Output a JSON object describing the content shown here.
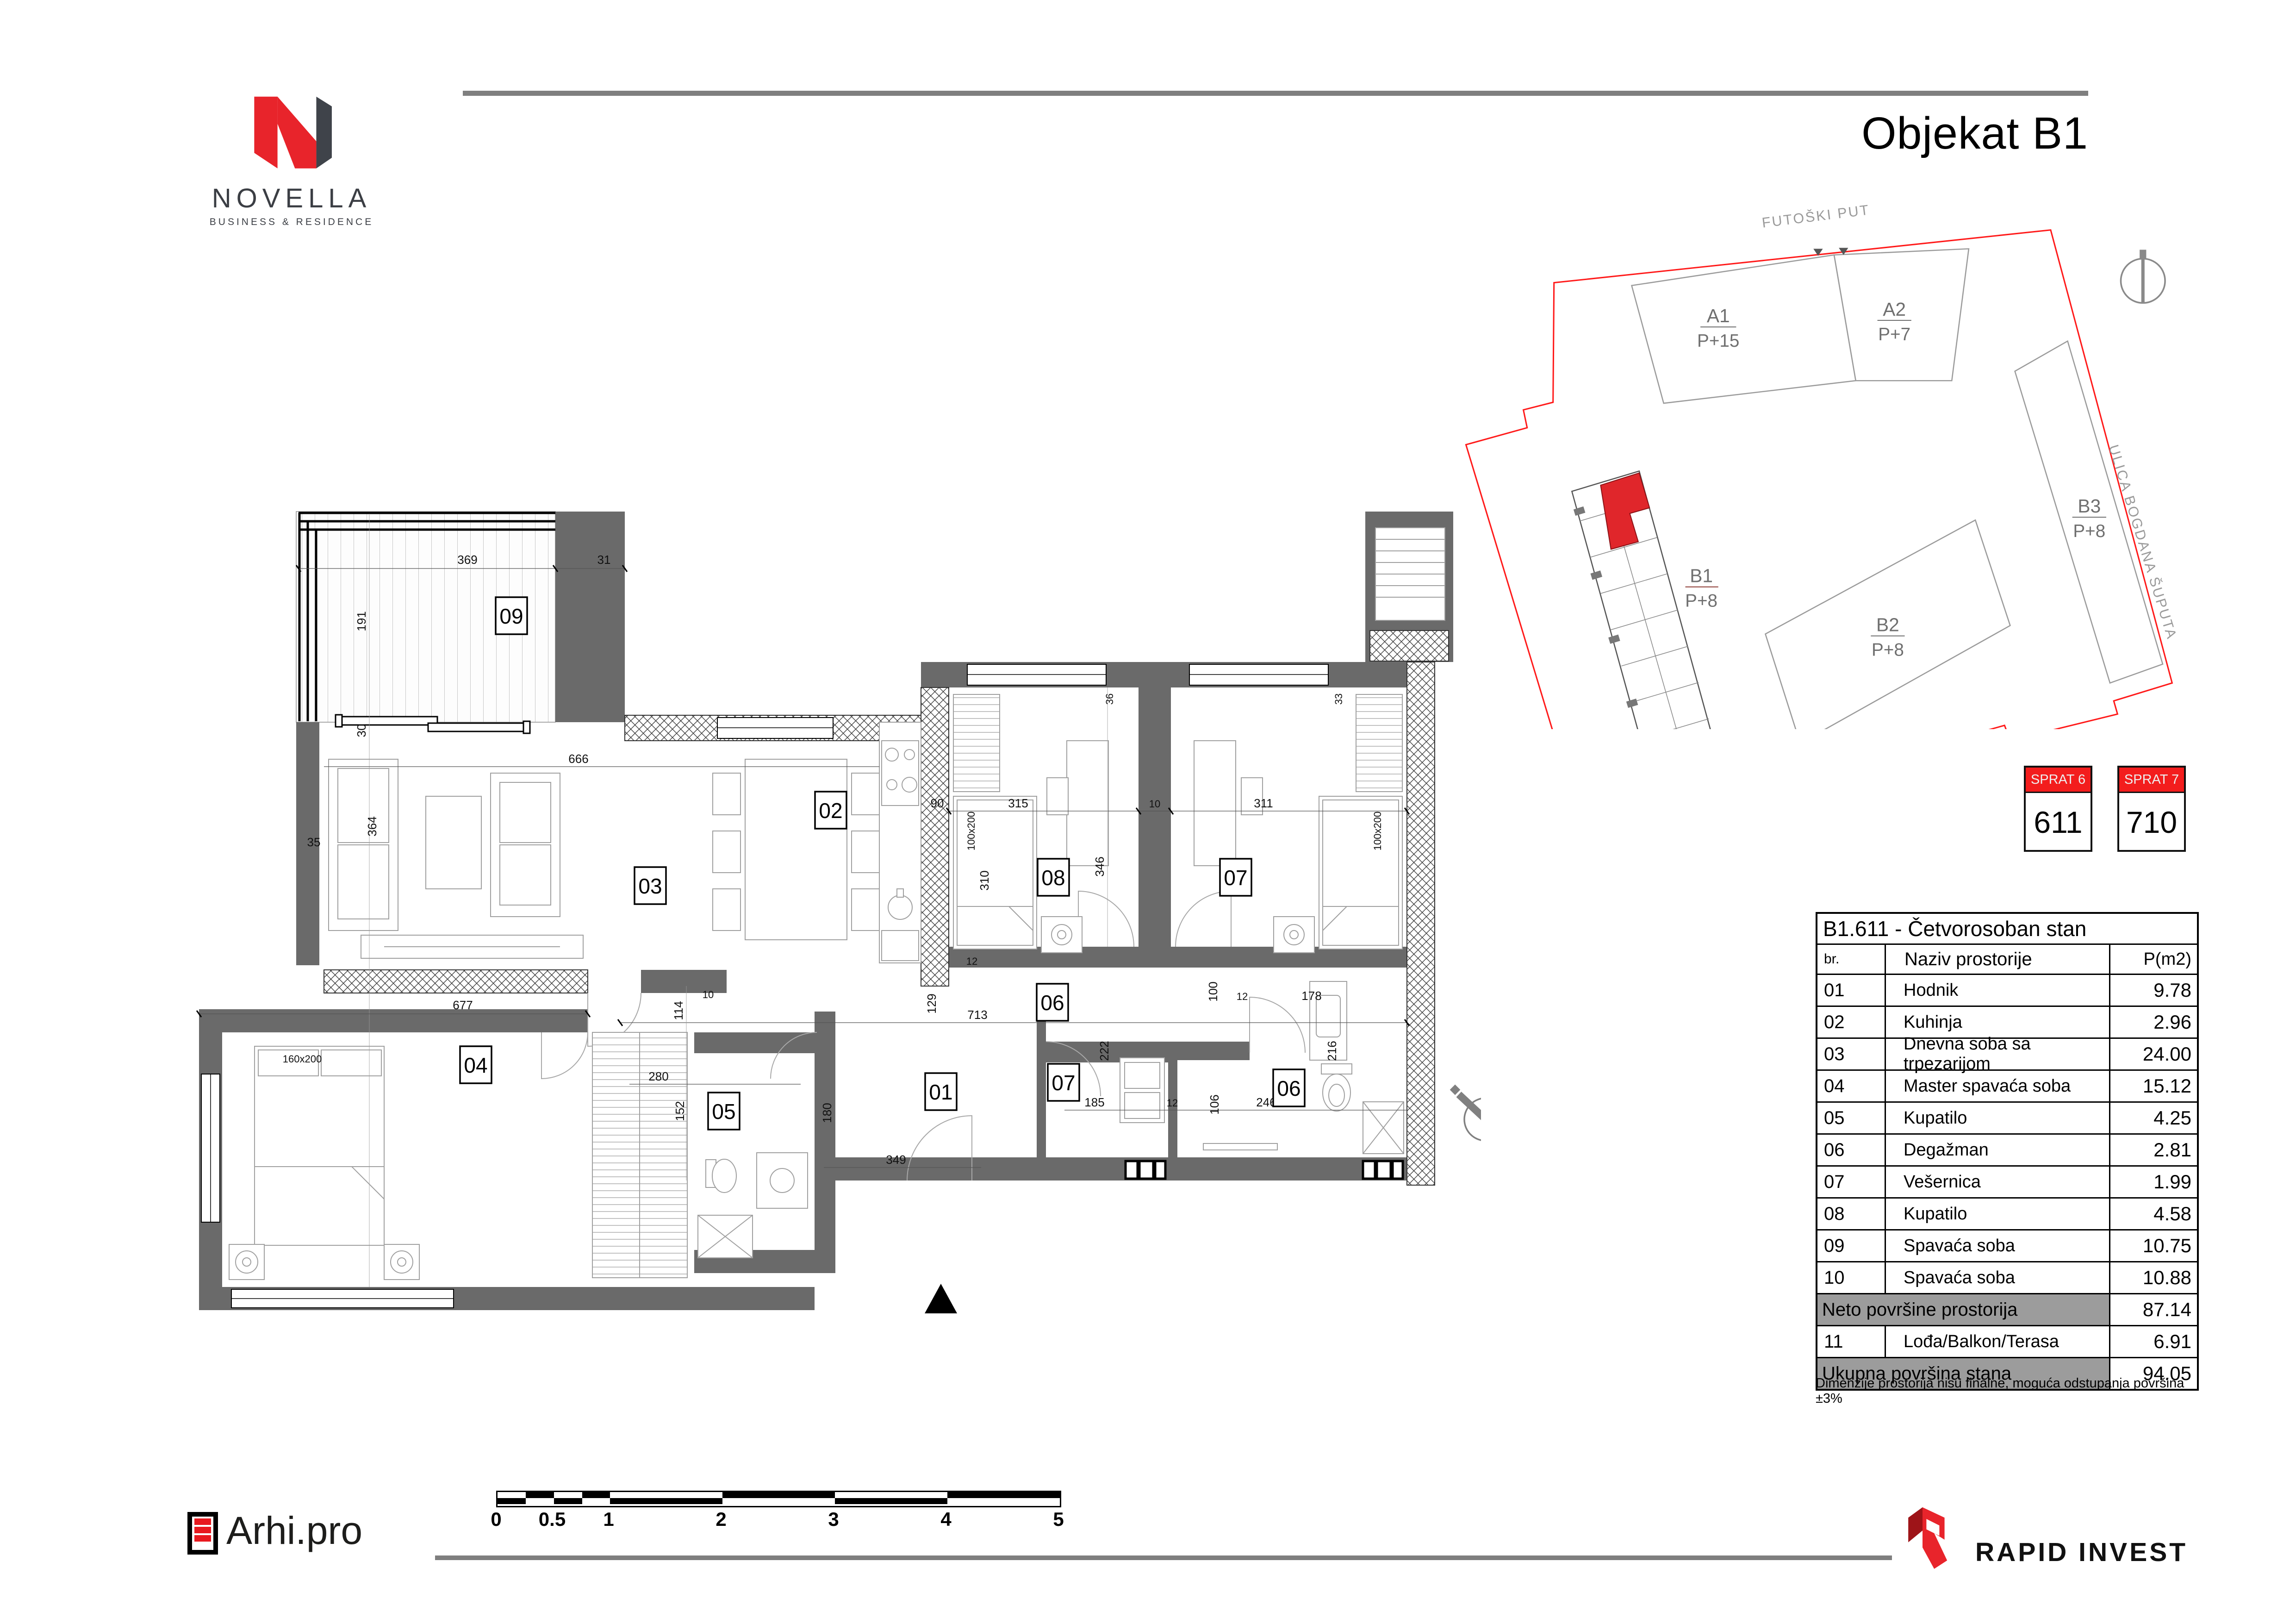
{
  "header": {
    "title": "Objekat B1",
    "brand": {
      "name": "NOVELLA",
      "tagline": "BUSINESS & RESIDENCE"
    }
  },
  "site_plan": {
    "streets": [
      {
        "name": "FUTOŠKI PUT"
      },
      {
        "name": "ULICA BOGDANA ŠUPUTA"
      },
      {
        "name": "DUBROVAČKA ULICA"
      }
    ],
    "buildings": [
      {
        "name": "A1",
        "floors": "P+15"
      },
      {
        "name": "A2",
        "floors": "P+7"
      },
      {
        "name": "B3",
        "floors": "P+8"
      },
      {
        "name": "B2",
        "floors": "P+8"
      },
      {
        "name": "B1",
        "floors": "P+8"
      }
    ]
  },
  "badges": [
    {
      "floor_label": "SPRAT 6",
      "unit": "611"
    },
    {
      "floor_label": "SPRAT 7",
      "unit": "710"
    }
  ],
  "table": {
    "title": "B1.611 - Četvorosoban stan",
    "columns": {
      "num": "br.",
      "name": "Naziv prostorije",
      "area": "P(m2)"
    },
    "rows": [
      {
        "num": "01",
        "name": "Hodnik",
        "area": "9.78"
      },
      {
        "num": "02",
        "name": "Kuhinja",
        "area": "2.96"
      },
      {
        "num": "03",
        "name": "Dnevna soba sa trpezarijom",
        "area": "24.00"
      },
      {
        "num": "04",
        "name": "Master spavaća soba",
        "area": "15.12"
      },
      {
        "num": "05",
        "name": "Kupatilo",
        "area": "4.25"
      },
      {
        "num": "06",
        "name": "Degažman",
        "area": "2.81"
      },
      {
        "num": "07",
        "name": "Vešernica",
        "area": "1.99"
      },
      {
        "num": "08",
        "name": "Kupatilo",
        "area": "4.58"
      },
      {
        "num": "09",
        "name": "Spavaća soba",
        "area": "10.75"
      },
      {
        "num": "10",
        "name": "Spavaća soba",
        "area": "10.88"
      }
    ],
    "net": {
      "label": "Neto površine prostorija",
      "value": "87.14"
    },
    "row11": {
      "num": "11",
      "name": "Lođa/Balkon/Terasa",
      "value": "6.91"
    },
    "total": {
      "label": "Ukupna površina stana",
      "value": "94.05"
    },
    "note": "Dimenzije prostorija nisu finalne, moguća odstupanja površina  ±3%"
  },
  "plan": {
    "room_labels": [
      {
        "n": "09"
      },
      {
        "n": "03"
      },
      {
        "n": "02"
      },
      {
        "n": "08"
      },
      {
        "n": "07"
      },
      {
        "n": "06"
      },
      {
        "n": "01"
      },
      {
        "n": "07"
      },
      {
        "n": "06"
      },
      {
        "n": "04"
      },
      {
        "n": "05"
      }
    ],
    "dims": [
      {
        "t": "369"
      },
      {
        "t": "31"
      },
      {
        "t": "191"
      },
      {
        "t": "30"
      },
      {
        "t": "666"
      },
      {
        "t": "364"
      },
      {
        "t": "35"
      },
      {
        "t": "90"
      },
      {
        "t": "310"
      },
      {
        "t": "315"
      },
      {
        "t": "10"
      },
      {
        "t": "311"
      },
      {
        "t": "346"
      },
      {
        "t": "36"
      },
      {
        "t": "33"
      },
      {
        "t": "677"
      },
      {
        "t": "713"
      },
      {
        "t": "114"
      },
      {
        "t": "10"
      },
      {
        "t": "129"
      },
      {
        "t": "222"
      },
      {
        "t": "100"
      },
      {
        "t": "12"
      },
      {
        "t": "178"
      },
      {
        "t": "185"
      },
      {
        "t": "12"
      },
      {
        "t": "106"
      },
      {
        "t": "246"
      },
      {
        "t": "216"
      },
      {
        "t": "280"
      },
      {
        "t": "152"
      },
      {
        "t": "180"
      },
      {
        "t": "349"
      },
      {
        "t": "12"
      }
    ],
    "bed_sizes": [
      {
        "t": "160x200"
      },
      {
        "t": "100x200"
      },
      {
        "t": "100x200"
      }
    ]
  },
  "scalebar": {
    "labels": [
      {
        "v": "0"
      },
      {
        "v": "0.5"
      },
      {
        "v": "1"
      },
      {
        "v": "2"
      },
      {
        "v": "3"
      },
      {
        "v": "4"
      },
      {
        "v": "5"
      }
    ]
  },
  "footer": {
    "arhi": "Arhi.pro",
    "rapid": "RAPID INVEST"
  },
  "colors": {
    "accent_red": "#ed1c24",
    "wall_gray": "#6a6a6a",
    "rule_gray": "#7f7f7f",
    "summary_gray": "#9c9c9c",
    "boundary_red": "#ff0000"
  }
}
